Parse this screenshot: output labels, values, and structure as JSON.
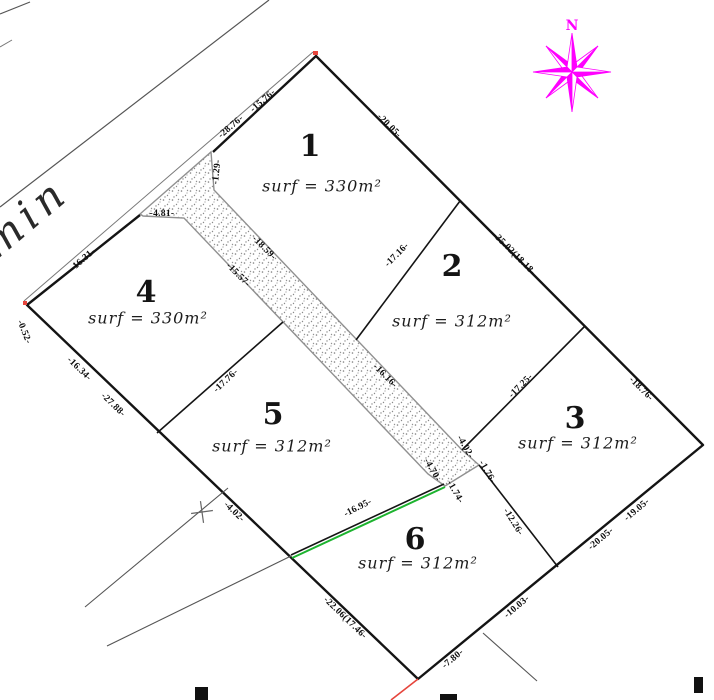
{
  "plan": {
    "north_label": "N",
    "road_label": "chemin",
    "lots": [
      {
        "number": "1",
        "surface": "surf = 330m²"
      },
      {
        "number": "2",
        "surface": "surf = 312m²"
      },
      {
        "number": "3",
        "surface": "surf = 312m²"
      },
      {
        "number": "4",
        "surface": "surf = 330m²"
      },
      {
        "number": "5",
        "surface": "surf = 312m²"
      },
      {
        "number": "6",
        "surface": "surf = 312m²"
      }
    ],
    "dimension_labels": [
      "-15.76-",
      "-28.76-",
      "-1.29-",
      "-4.81-",
      "-16.31-",
      "-0.52-",
      "-20.05-",
      "-35.02(18.18-",
      "-18.76-",
      "-19.05-",
      "-20.05-",
      "-10.03-",
      "-7.80-",
      "-16.34-",
      "-27.88-",
      "-4.02-",
      "-22.06(17.46-",
      "-16.95-",
      "-18.59-",
      "-15.57-",
      "-16.16-",
      "-4.70-",
      "-4.02-",
      "-1.74-",
      "-1.76-",
      "-17.16-",
      "-17.25-",
      "-17.76-",
      "-12.26-"
    ],
    "colors": {
      "boundary": "#141414",
      "road_edge": "#555555",
      "thin_line": "#777777",
      "compass": "#ff00ff",
      "green_line": "#1db32f",
      "red_line": "#e6453c",
      "stipple": "#8a8a8a"
    }
  }
}
